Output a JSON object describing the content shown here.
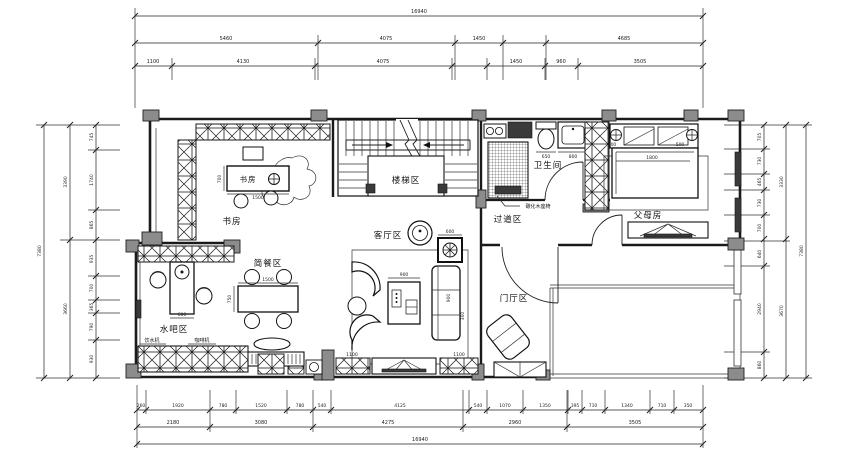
{
  "drawing": {
    "rooms": {
      "study": "书房",
      "study_desk": "书房",
      "stairs": "楼梯区",
      "bathroom": "卫生间",
      "corridor": "过道区",
      "parents_room": "父母房",
      "living_room": "客厅区",
      "dining": "简餐区",
      "water_bar": "水吧区",
      "foyer": "门厅区"
    },
    "annotations": {
      "wood_seat": "碳化木座椅",
      "water_dispenser": "饮水机",
      "coffee_machine": "咖啡机"
    },
    "colors": {
      "line": "#1a1a1a",
      "wall_fill": "#8c8c8c",
      "dark_fill": "#3a3a3a",
      "background": "#ffffff"
    }
  },
  "dimensions": {
    "top": {
      "total": "16940",
      "row2": [
        "5460",
        "4075",
        "1450",
        "4685"
      ],
      "row3": [
        "1100",
        "4130",
        "4075",
        "1450",
        "960",
        "3505"
      ]
    },
    "bottom": {
      "row1": [
        "260",
        "1920",
        "780",
        "1520",
        "780",
        "540",
        "4125",
        "540",
        "1070",
        "1350",
        "395",
        "710",
        "1340",
        "710",
        "350"
      ],
      "row2": [
        "2180",
        "3080",
        "4275",
        "2960",
        "3505"
      ],
      "total": "16940"
    },
    "left": {
      "segments": [
        "745",
        "1740",
        "865",
        "935",
        "700",
        "365",
        "790",
        "930"
      ],
      "mid": [
        "3390",
        "3660"
      ],
      "total": "7380"
    },
    "right": {
      "segments": [
        "705",
        "730",
        "465",
        "730",
        "700",
        "640",
        "2940",
        "860"
      ],
      "mid": [
        "3330",
        "3670"
      ],
      "total": "7380"
    },
    "inline": {
      "desk_depth": "700",
      "desk_width": "1500",
      "headboard_left": "300",
      "headboard_right": "500",
      "bed_width": "1800",
      "fireplace": "600",
      "coffee_table": "900",
      "sofa_length": "900",
      "sofa_depth": "300",
      "tv_cabinet_left": "1100",
      "tv_cabinet_right": "1100",
      "dining_table_width": "1500",
      "dining_table_depth": "750",
      "bar_width": "600",
      "sideboard": "1500",
      "toilet": "650",
      "basin": "800"
    }
  }
}
